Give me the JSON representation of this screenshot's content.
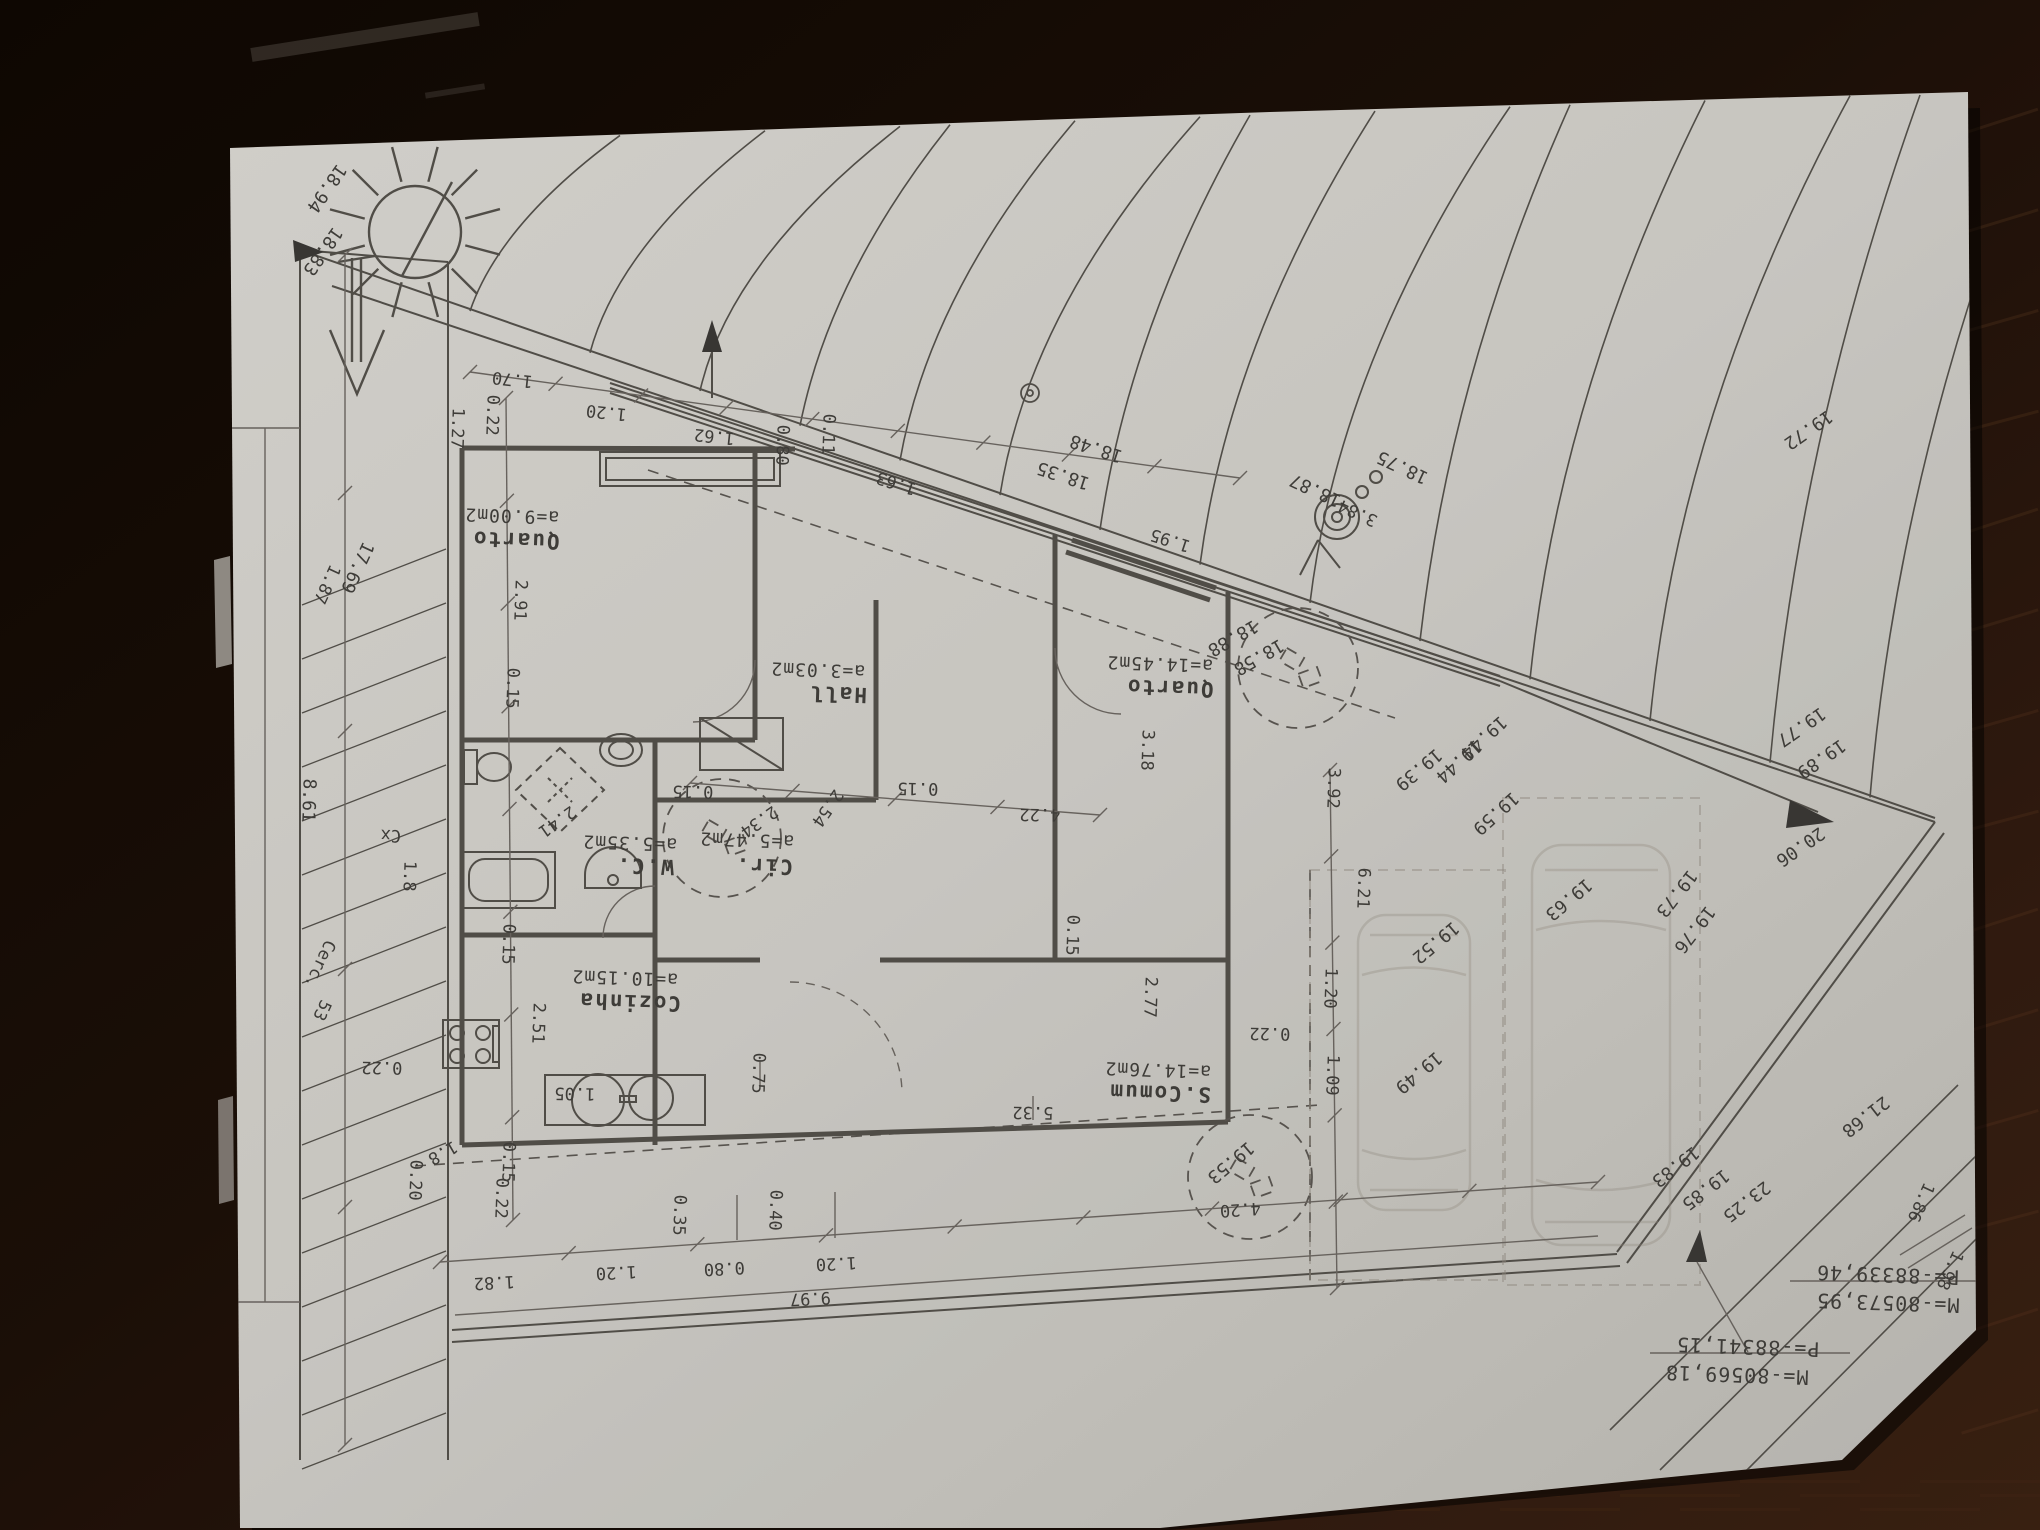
{
  "photo": {
    "subject": "architectural site and floor plan sheet, rotated 180 degrees, on dark wood table",
    "paper_color": "#d9d7d1",
    "table_color": "#1b0f07",
    "ink_color": "#56524c"
  },
  "rooms": [
    {
      "name": "Quarto",
      "area": "a=9.00m2"
    },
    {
      "name": "Hall",
      "area": "a=3.03m2"
    },
    {
      "name": "Quarto",
      "area": "a=14.45m2"
    },
    {
      "name": "W.C.",
      "area": "a=5.35m2"
    },
    {
      "name": "Cir.",
      "area": "a=5.47m2"
    },
    {
      "name": "Cozinha",
      "area": "a=10.15m2"
    },
    {
      "name": "S.Comum",
      "area": "a=14.76m2"
    }
  ],
  "survey_marks": [
    {
      "m": "M=-80573,95",
      "p": "P=-88339,46"
    },
    {
      "m": "M=-80569,18",
      "p": "P=-88341,15"
    }
  ],
  "symbols": [
    "sun-icon",
    "north-arrow-icon",
    "tree-icon",
    "car-sketch",
    "benchmark-triangle",
    "utility-pole-icon",
    "fence-hatch",
    "stove-icon",
    "bathtub-icon",
    "toilet-icon",
    "sink-icon"
  ],
  "labels": [
    {
      "t": "0.22",
      "x": 487,
      "y": 415,
      "r": 92,
      "c": "d"
    },
    {
      "t": "1.70",
      "x": 513,
      "y": 374,
      "r": 186,
      "c": "d"
    },
    {
      "t": "1.20",
      "x": 607,
      "y": 407,
      "r": 186,
      "c": "d"
    },
    {
      "t": "1.62",
      "x": 715,
      "y": 431,
      "r": 186,
      "c": "d"
    },
    {
      "t": "0.80",
      "x": 777,
      "y": 445,
      "r": 92,
      "c": "d"
    },
    {
      "t": "0.11",
      "x": 823,
      "y": 434,
      "r": 92,
      "c": "d"
    },
    {
      "t": "1.63",
      "x": 898,
      "y": 478,
      "r": 198,
      "c": "d"
    },
    {
      "t": "1.95",
      "x": 1172,
      "y": 535,
      "r": 198,
      "c": "d"
    },
    {
      "t": "1.27",
      "x": 452,
      "y": 428,
      "r": 92,
      "c": "d"
    },
    {
      "t": "18.94",
      "x": 322,
      "y": 185,
      "r": 125,
      "c": "e"
    },
    {
      "t": "18.83",
      "x": 318,
      "y": 248,
      "r": 125,
      "c": "e"
    },
    {
      "t": "18.35",
      "x": 1065,
      "y": 470,
      "r": 198,
      "c": "e"
    },
    {
      "t": "18.48",
      "x": 1098,
      "y": 443,
      "r": 198,
      "c": "e"
    },
    {
      "t": "18.87",
      "x": 1318,
      "y": 485,
      "r": 205,
      "c": "e"
    },
    {
      "t": "18.75",
      "x": 1405,
      "y": 462,
      "r": 205,
      "c": "e"
    },
    {
      "t": "3.84",
      "x": 1360,
      "y": 508,
      "r": 205,
      "c": "d"
    },
    {
      "t": "18.88",
      "x": 1230,
      "y": 633,
      "r": 150,
      "c": "e"
    },
    {
      "t": "18.58",
      "x": 1256,
      "y": 652,
      "r": 150,
      "c": "e"
    },
    {
      "t": "17.69",
      "x": 352,
      "y": 565,
      "r": 115,
      "c": "e"
    },
    {
      "t": "1.87",
      "x": 322,
      "y": 582,
      "r": 115,
      "c": "d"
    },
    {
      "t": "8.61",
      "x": 303,
      "y": 800,
      "r": 92,
      "c": "e"
    },
    {
      "t": "Cerc.",
      "x": 315,
      "y": 962,
      "r": 115,
      "c": "d"
    },
    {
      "t": "53",
      "x": 317,
      "y": 1008,
      "r": 115,
      "c": "d"
    },
    {
      "t": "Cx",
      "x": 391,
      "y": 830,
      "r": 182,
      "c": "d"
    },
    {
      "t": "1.8",
      "x": 404,
      "y": 876,
      "r": 92,
      "c": "d"
    },
    {
      "t": "0.22",
      "x": 382,
      "y": 1062,
      "r": 181,
      "c": "d"
    },
    {
      "t": "0.20",
      "x": 410,
      "y": 1180,
      "r": 92,
      "c": "d"
    },
    {
      "t": "1.8",
      "x": 440,
      "y": 1148,
      "r": 150,
      "c": "d"
    },
    {
      "t": "2.91",
      "x": 515,
      "y": 600,
      "r": 92,
      "c": "d"
    },
    {
      "t": "0.15",
      "x": 507,
      "y": 688,
      "r": 92,
      "c": "d"
    },
    {
      "t": "0.15",
      "x": 503,
      "y": 944,
      "r": 92,
      "c": "d"
    },
    {
      "t": "2.51",
      "x": 533,
      "y": 1023,
      "r": 92,
      "c": "d"
    },
    {
      "t": "0.15",
      "x": 503,
      "y": 1162,
      "r": 92,
      "c": "d"
    },
    {
      "t": "0.22",
      "x": 496,
      "y": 1198,
      "r": 92,
      "c": "d"
    },
    {
      "t": "Quarto",
      "x": 516,
      "y": 533,
      "r": 182,
      "c": "r"
    },
    {
      "t": "a=9.00m2",
      "x": 512,
      "y": 510,
      "r": 182,
      "c": "a"
    },
    {
      "t": "Hall",
      "x": 838,
      "y": 687,
      "r": 182,
      "c": "r"
    },
    {
      "t": "a=3.03m2",
      "x": 818,
      "y": 664,
      "r": 182,
      "c": "a"
    },
    {
      "t": "Quarto",
      "x": 1170,
      "y": 681,
      "r": 182,
      "c": "r"
    },
    {
      "t": "a=14.45m2",
      "x": 1160,
      "y": 658,
      "r": 182,
      "c": "a"
    },
    {
      "t": "W.C.",
      "x": 645,
      "y": 859,
      "r": 182,
      "c": "r"
    },
    {
      "t": "a=5.35m2",
      "x": 630,
      "y": 837,
      "r": 182,
      "c": "a"
    },
    {
      "t": "Cir.",
      "x": 764,
      "y": 859,
      "r": 182,
      "c": "r"
    },
    {
      "t": "a=5.47m2",
      "x": 747,
      "y": 834,
      "r": 182,
      "c": "a"
    },
    {
      "t": "Cozinha",
      "x": 630,
      "y": 995,
      "r": 182,
      "c": "r"
    },
    {
      "t": "a=10.15m2",
      "x": 625,
      "y": 972,
      "r": 182,
      "c": "a"
    },
    {
      "t": "S.Comum",
      "x": 1160,
      "y": 1086,
      "r": 182,
      "c": "r"
    },
    {
      "t": "a=14.76m2",
      "x": 1158,
      "y": 1064,
      "r": 182,
      "c": "a"
    },
    {
      "t": "2.41",
      "x": 554,
      "y": 817,
      "r": 145,
      "c": "d"
    },
    {
      "t": "2.34",
      "x": 756,
      "y": 817,
      "r": 145,
      "c": "d"
    },
    {
      "t": "2.54",
      "x": 823,
      "y": 805,
      "r": 125,
      "c": "d"
    },
    {
      "t": "0.15",
      "x": 693,
      "y": 786,
      "r": 181,
      "c": "d"
    },
    {
      "t": "0.15",
      "x": 918,
      "y": 783,
      "r": 181,
      "c": "d"
    },
    {
      "t": "4.22",
      "x": 1040,
      "y": 809,
      "r": 181,
      "c": "d"
    },
    {
      "t": "3.18",
      "x": 1142,
      "y": 750,
      "r": 92,
      "c": "d"
    },
    {
      "t": "3.92",
      "x": 1328,
      "y": 788,
      "r": 92,
      "c": "d"
    },
    {
      "t": "6.21",
      "x": 1358,
      "y": 888,
      "r": 92,
      "c": "d"
    },
    {
      "t": "1.20",
      "x": 1325,
      "y": 988,
      "r": 92,
      "c": "d"
    },
    {
      "t": "0.22",
      "x": 1270,
      "y": 1028,
      "r": 181,
      "c": "d"
    },
    {
      "t": "1.09",
      "x": 1327,
      "y": 1075,
      "r": 92,
      "c": "d"
    },
    {
      "t": "2.77",
      "x": 1145,
      "y": 997,
      "r": 92,
      "c": "d"
    },
    {
      "t": "0.15",
      "x": 1067,
      "y": 935,
      "r": 92,
      "c": "d"
    },
    {
      "t": "5.32",
      "x": 1033,
      "y": 1107,
      "r": 181,
      "c": "d"
    },
    {
      "t": "0.75",
      "x": 753,
      "y": 1073,
      "r": 92,
      "c": "d"
    },
    {
      "t": "1.05",
      "x": 575,
      "y": 1088,
      "r": 181,
      "c": "d"
    },
    {
      "t": "1.82",
      "x": 494,
      "y": 1277,
      "r": 177,
      "c": "d"
    },
    {
      "t": "1.20",
      "x": 616,
      "y": 1267,
      "r": 177,
      "c": "d"
    },
    {
      "t": "0.35",
      "x": 674,
      "y": 1215,
      "r": 92,
      "c": "d"
    },
    {
      "t": "0.80",
      "x": 724,
      "y": 1263,
      "r": 177,
      "c": "d"
    },
    {
      "t": "0.40",
      "x": 770,
      "y": 1210,
      "r": 92,
      "c": "d"
    },
    {
      "t": "1.20",
      "x": 836,
      "y": 1258,
      "r": 177,
      "c": "d"
    },
    {
      "t": "9.97",
      "x": 810,
      "y": 1293,
      "r": 177,
      "c": "d"
    },
    {
      "t": "4.20",
      "x": 1240,
      "y": 1204,
      "r": 176,
      "c": "d"
    },
    {
      "t": "19.72",
      "x": 1805,
      "y": 425,
      "r": 145,
      "c": "e"
    },
    {
      "t": "19.77",
      "x": 1798,
      "y": 722,
      "r": 145,
      "c": "e"
    },
    {
      "t": "19.89",
      "x": 1818,
      "y": 754,
      "r": 145,
      "c": "e"
    },
    {
      "t": "20.06",
      "x": 1797,
      "y": 842,
      "r": 145,
      "c": "e"
    },
    {
      "t": "21.68",
      "x": 1862,
      "y": 1112,
      "r": 142,
      "c": "e"
    },
    {
      "t": "23.25",
      "x": 1743,
      "y": 1197,
      "r": 142,
      "c": "e"
    },
    {
      "t": "19.83",
      "x": 1672,
      "y": 1162,
      "r": 142,
      "c": "e"
    },
    {
      "t": "19.85",
      "x": 1702,
      "y": 1185,
      "r": 142,
      "c": "e"
    },
    {
      "t": "1.86",
      "x": 1916,
      "y": 1200,
      "r": 115,
      "c": "d"
    },
    {
      "t": "1.98",
      "x": 1945,
      "y": 1268,
      "r": 115,
      "c": "d"
    },
    {
      "t": "19.39",
      "x": 1415,
      "y": 765,
      "r": 140,
      "c": "e"
    },
    {
      "t": "19.44",
      "x": 1455,
      "y": 757,
      "r": 138,
      "c": "e"
    },
    {
      "t": "19.44",
      "x": 1480,
      "y": 733,
      "r": 138,
      "c": "e"
    },
    {
      "t": "19.59",
      "x": 1492,
      "y": 809,
      "r": 138,
      "c": "e"
    },
    {
      "t": "19.52",
      "x": 1432,
      "y": 938,
      "r": 140,
      "c": "e"
    },
    {
      "t": "19.49",
      "x": 1415,
      "y": 1068,
      "r": 140,
      "c": "e"
    },
    {
      "t": "19.63",
      "x": 1565,
      "y": 895,
      "r": 140,
      "c": "e"
    },
    {
      "t": "19.73",
      "x": 1672,
      "y": 890,
      "r": 128,
      "c": "e"
    },
    {
      "t": "19.76",
      "x": 1690,
      "y": 926,
      "r": 128,
      "c": "e"
    },
    {
      "t": "19.53",
      "x": 1227,
      "y": 1158,
      "r": 140,
      "c": "e"
    },
    {
      "t": "P=-88339,46",
      "x": 1888,
      "y": 1268,
      "r": 182,
      "c": "g"
    },
    {
      "t": "M=-80573,95",
      "x": 1888,
      "y": 1296,
      "r": 182,
      "c": "g"
    },
    {
      "t": "P=-88341,15",
      "x": 1748,
      "y": 1340,
      "r": 182,
      "c": "g"
    },
    {
      "t": "M=-80569,18",
      "x": 1737,
      "y": 1368,
      "r": 182,
      "c": "g"
    }
  ]
}
